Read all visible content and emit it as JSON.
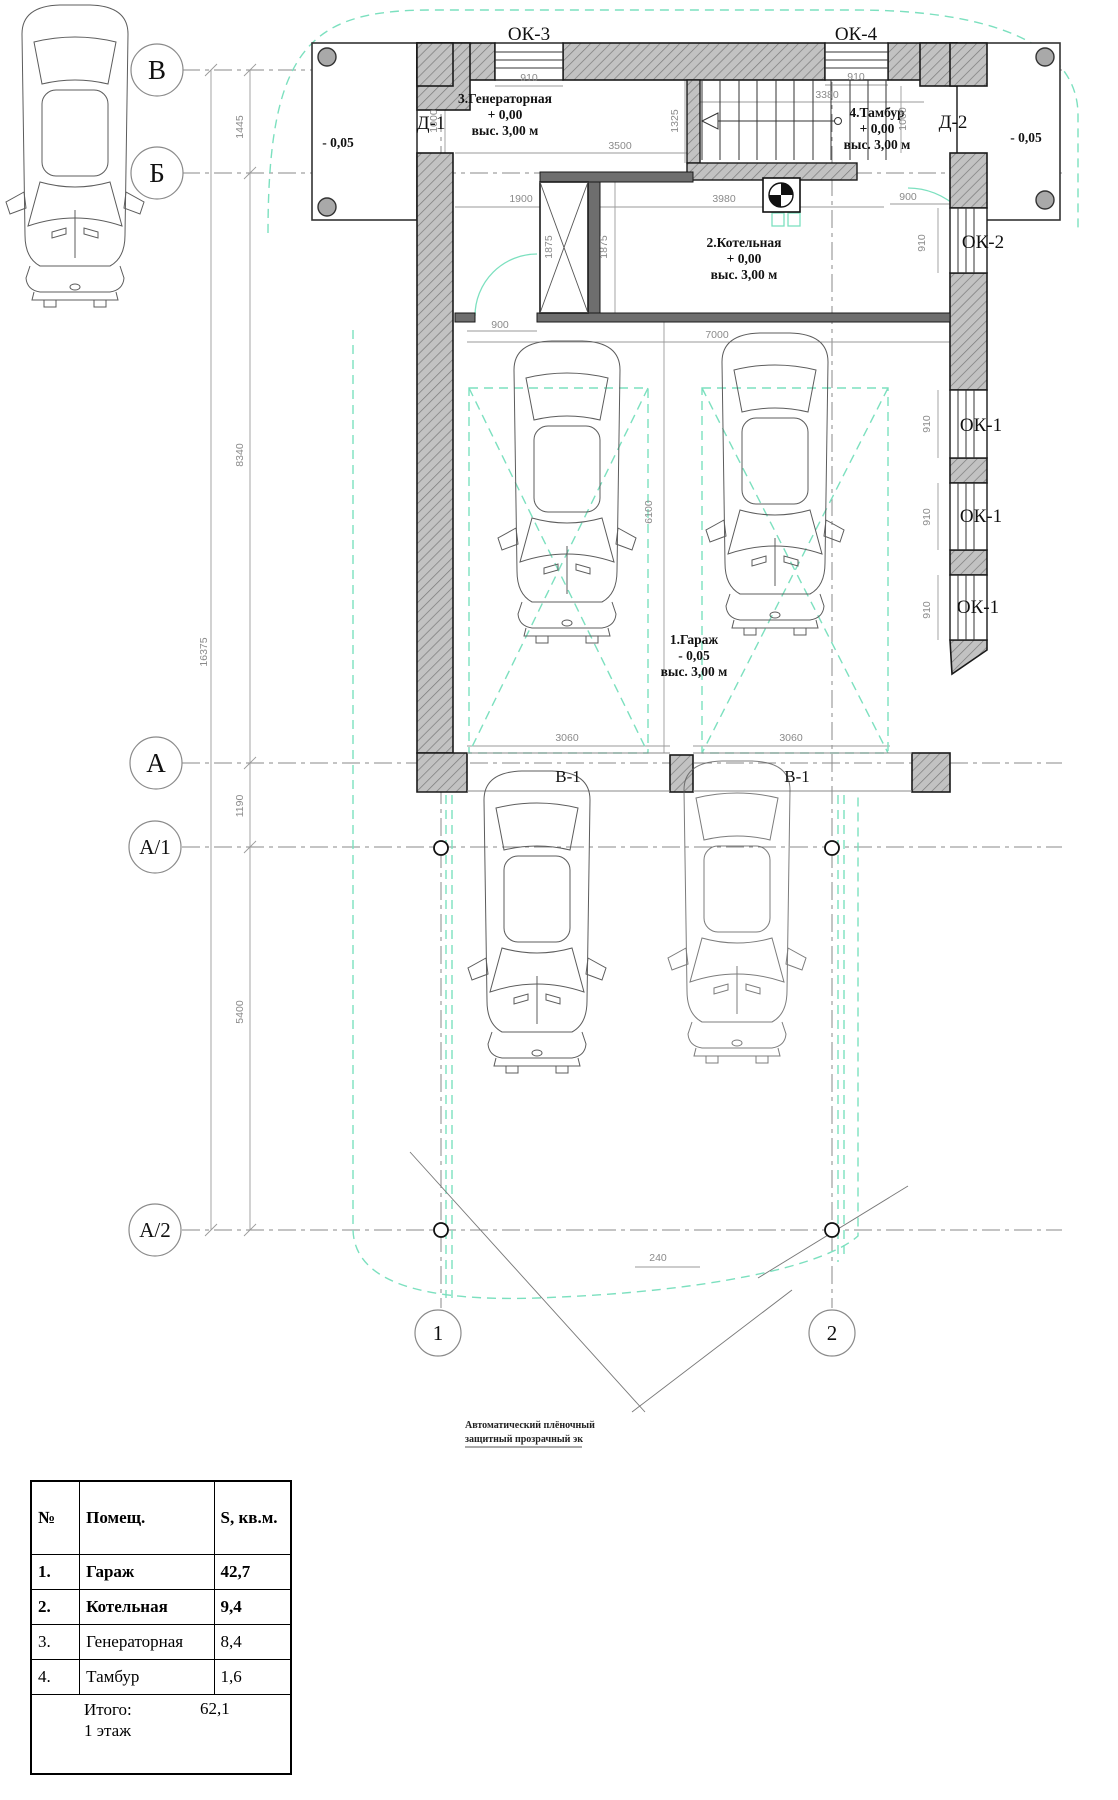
{
  "colors": {
    "teal": "#7ce0bf",
    "wall_fill": "#c2c2c2",
    "hatch_line": "#7a7a7a"
  },
  "plan": {
    "axes": {
      "B": "В",
      "Bb": "Б",
      "A": "А",
      "A1": "А/1",
      "A2": "А/2",
      "n1": "1",
      "n2": "2"
    },
    "windows": {
      "ok3": "ОК-3",
      "ok4": "ОК-4",
      "ok2": "ОК-2",
      "ok1a": "ОК-1",
      "ok1b": "ОК-1",
      "ok1c": "ОК-1"
    },
    "doors": {
      "d1": "Д-1",
      "d2": "Д-2"
    },
    "levels": {
      "porch_left": "- 0,05",
      "porch_right": "- 0,05"
    },
    "beams": {
      "left": "В-1",
      "right": "В-1"
    },
    "rooms": {
      "generator": {
        "name": "3.Генераторная",
        "level": "+ 0,00",
        "height": "выс. 3,00 м"
      },
      "tambur": {
        "name": "4.Тамбур",
        "level": "+ 0,00",
        "height": "выс. 3,00 м"
      },
      "boiler": {
        "name": "2.Котельная",
        "level": "+ 0,00",
        "height": "выс. 3,00 м"
      },
      "garage": {
        "name": "1.Гараж",
        "level": "- 0,05",
        "height": "выс. 3,00 м"
      }
    },
    "dims": {
      "v1445": "1445",
      "v8340": "8340",
      "v16375": "16375",
      "v1190": "1190",
      "v5400": "5400",
      "ok3_w": "910",
      "ok4_w": "910",
      "t3380": "3380",
      "w3500": "3500",
      "s1325": "1325",
      "d1_w": "1000",
      "d2_w": "1000",
      "k1900": "1900",
      "k3980": "3980",
      "sh1875a": "1875",
      "sh1875b": "1875",
      "g900l": "900",
      "g7000": "7000",
      "t900r": "900",
      "ok2_h": "910",
      "ok1a_h": "910",
      "ok1b_h": "910",
      "ok1c_h": "910",
      "g6100": "6100",
      "b3060l": "3060",
      "b3060r": "3060",
      "b240": "240"
    }
  },
  "annotation": {
    "line1": "Автоматический плёночный",
    "line2": "защитный прозрачный эк"
  },
  "table": {
    "headers": [
      "№",
      "Помещ.",
      "S, кв.м."
    ],
    "rows": [
      [
        "1.",
        "Гараж",
        "42,7"
      ],
      [
        "2.",
        "Котельная",
        "9,4"
      ],
      [
        "3.",
        "Генераторная",
        "8,4"
      ],
      [
        "4.",
        "Тамбур",
        "1,6"
      ]
    ],
    "total_label": "Итого:",
    "total_sublabel": "1 этаж",
    "total_value": "62,1"
  }
}
